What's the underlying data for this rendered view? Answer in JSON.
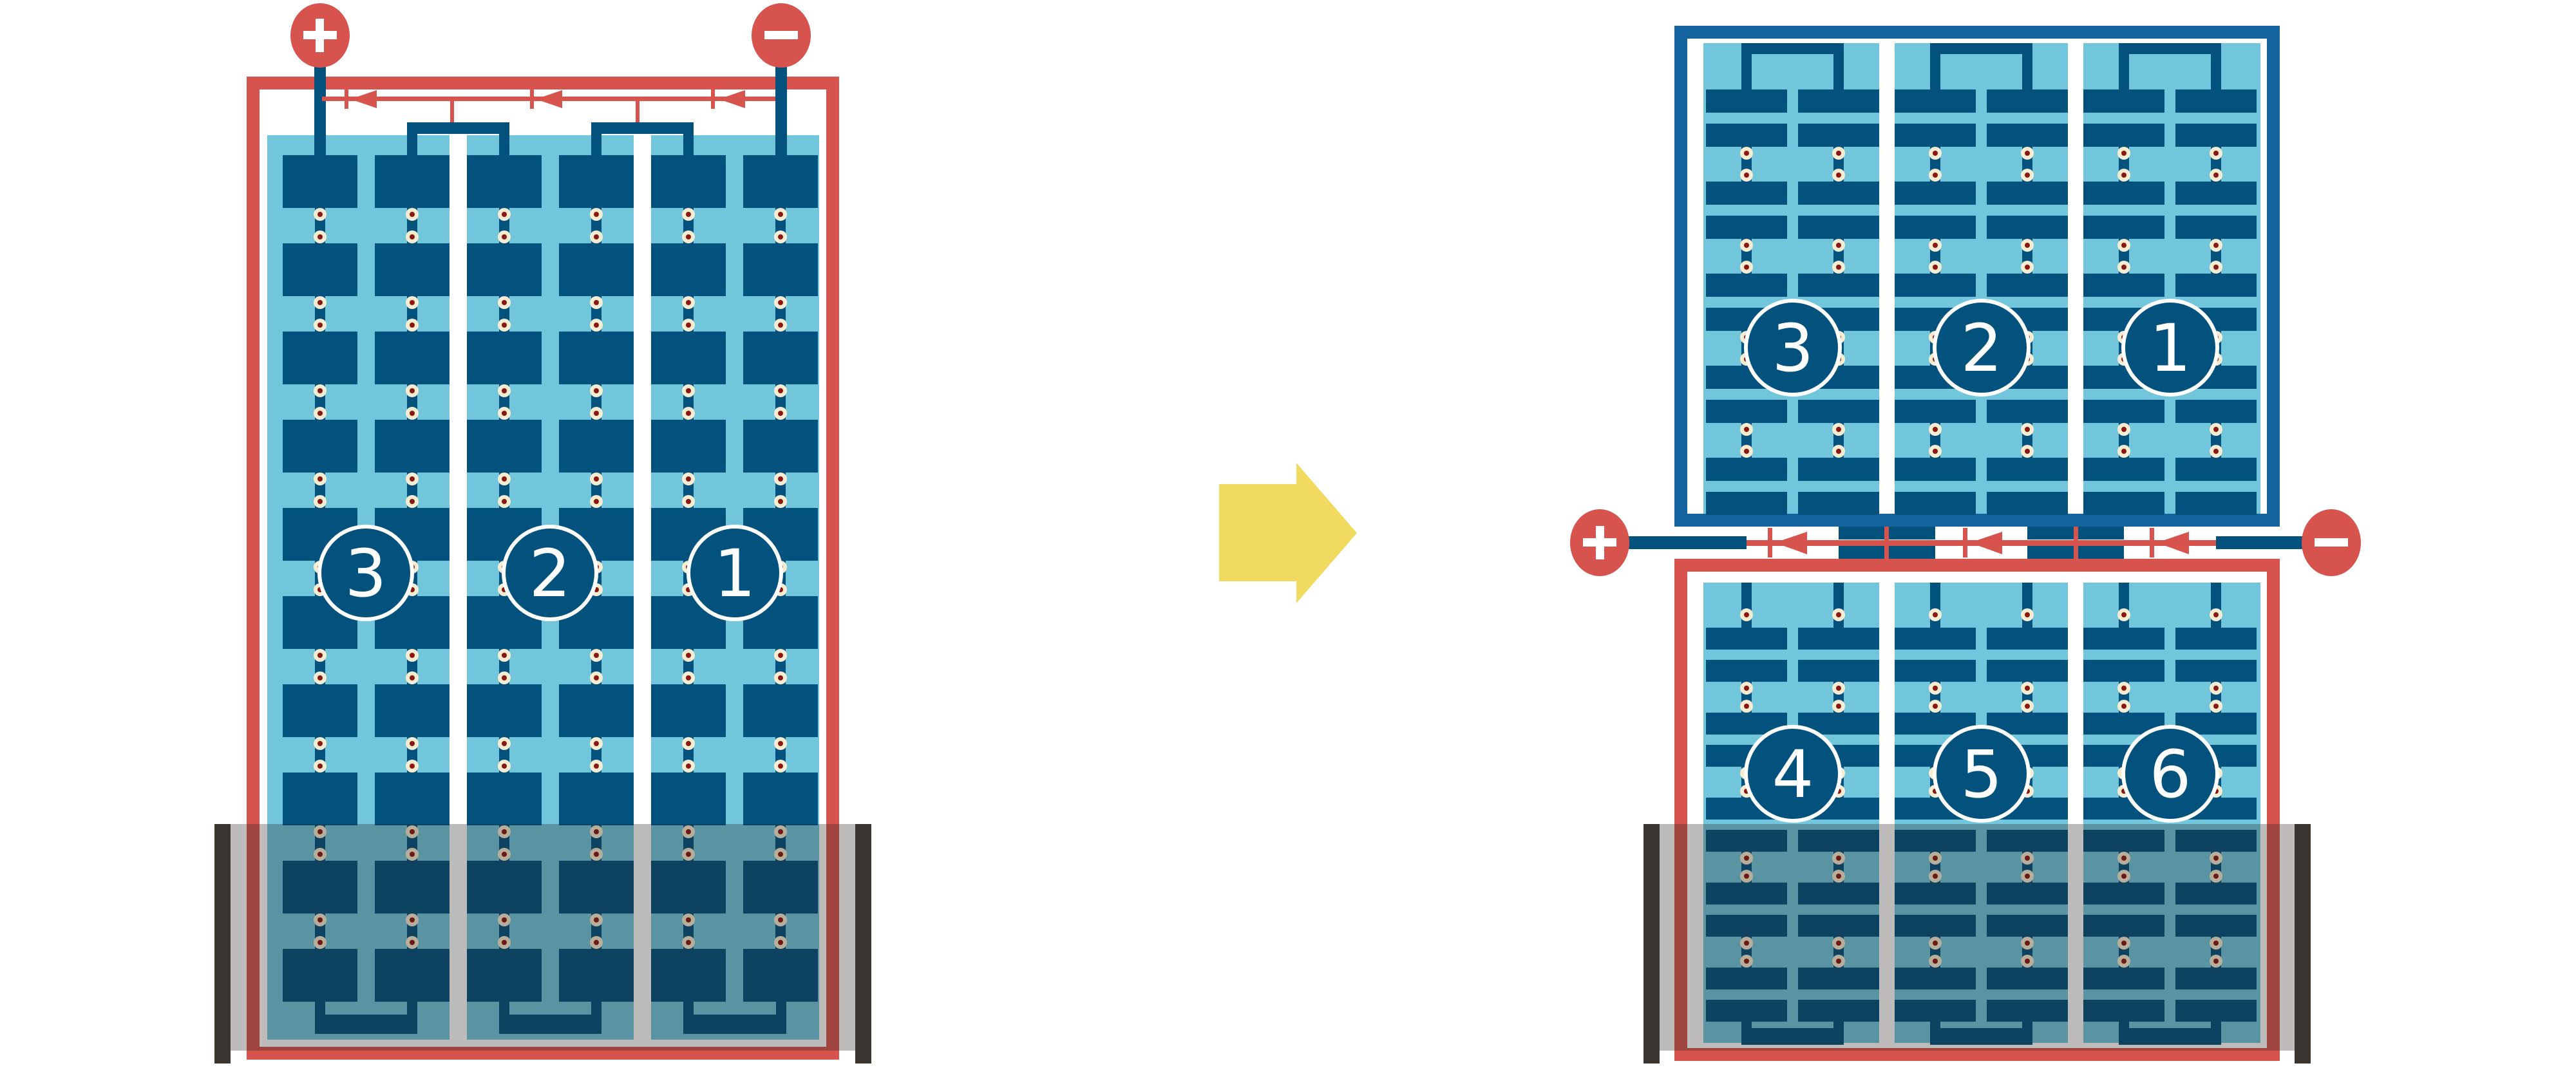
{
  "figure": {
    "colors": {
      "background": "#ffffff",
      "wire_red": "#d6534e",
      "panel_light_blue": "#72c6dc",
      "cell_dark_blue": "#03517d",
      "frame_blue": "#14639c",
      "solder_pad_cream": "#f6ecd2",
      "solder_pad_center": "#8a1711",
      "shade_bar_gray": "#3a3531",
      "shade_overlay": "rgba(35,32,30,0.30)",
      "arrow_yellow": "#f1da60"
    },
    "left_module": {
      "positive_terminal": "+",
      "negative_terminal": "−",
      "string_labels": [
        "3",
        "2",
        "1"
      ],
      "bypass_diode_count": "3"
    },
    "right_module": {
      "positive_terminal": "+",
      "negative_terminal": "−",
      "top_string_labels": [
        "3",
        "2",
        "1"
      ],
      "bottom_string_labels": [
        "4",
        "5",
        "6"
      ],
      "bypass_diode_count": "3"
    }
  }
}
